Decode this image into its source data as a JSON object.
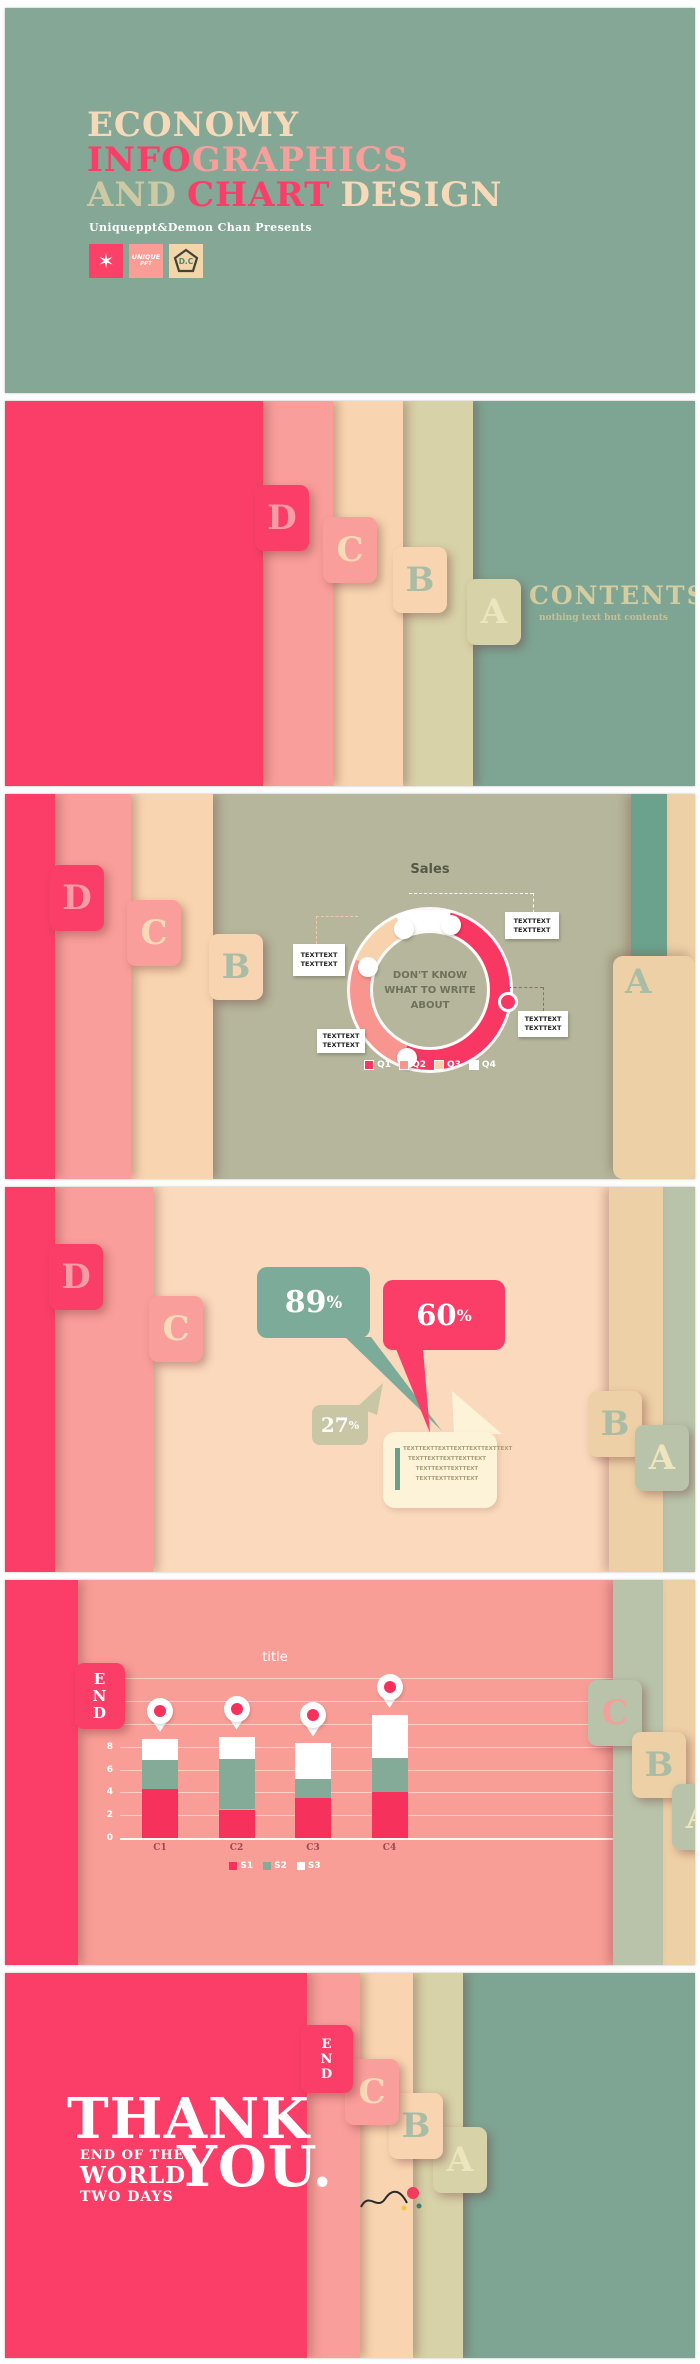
{
  "slide1": {
    "title": {
      "economy": "ECONOMY",
      "info": "INFO",
      "graphics": "GRAPHICS",
      "and": "AND",
      "chart": "CHART",
      "design": "DESIGN"
    },
    "presenter": "Uniqueppt&Demon Chan Presents",
    "badges": {
      "star_icon": "✶",
      "unique_line1": "UNIQUE",
      "unique_line2": "PPT",
      "dc_text": "D.C"
    }
  },
  "slide2": {
    "tabs": {
      "d": "D",
      "c": "C",
      "b": "B",
      "a": "A"
    },
    "contents_title": "CONTENTS",
    "contents_subtitle": "nothing text but contents"
  },
  "slide3": {
    "tabs": {
      "d": "D",
      "c": "C",
      "b": "B",
      "a": "A"
    },
    "callout_line1": "TEXTTEXT",
    "callout_line2": "TEXTTEXT"
  },
  "slide4": {
    "tabs": {
      "d": "D",
      "c": "C",
      "b": "B",
      "a": "A"
    },
    "bubble_green": {
      "value": "89",
      "unit": "%"
    },
    "bubble_red": {
      "value": "60",
      "unit": "%"
    },
    "bubble_olive": {
      "value": "27",
      "unit": "%"
    },
    "note_lines": [
      "TEXTTEXTTEXTTEXTTEXTTEXTTEXT",
      "TEXTTEXTTEXTTEXTTEXT",
      "TEXTTEXTTEXTTEXT",
      "TEXTTEXTTEXTTEXT"
    ]
  },
  "slide5": {
    "end_tab": [
      "E",
      "N",
      "D"
    ],
    "tabs": {
      "c": "C",
      "b": "B",
      "a": "A"
    }
  },
  "slide6": {
    "end_tab": [
      "E",
      "N",
      "D"
    ],
    "tabs": {
      "c": "C",
      "b": "B",
      "a": "A"
    },
    "thank": "THANK",
    "you": "YOU.",
    "sub_line1": "END OF THE",
    "sub_line2": "WORLD",
    "sub_line3": "TWO DAYS"
  },
  "chart_data": [
    {
      "type": "pie",
      "variant": "donut",
      "title": "Sales",
      "labels": [
        "Q1",
        "Q2",
        "Q3",
        "Q4"
      ],
      "values": [
        52,
        25,
        12,
        11
      ],
      "colors": [
        "#f93763",
        "#f8958e",
        "#f7d3ad",
        "#ffffff"
      ],
      "start_angle_deg": 15,
      "marker_angle_deg": 97,
      "center_text": [
        "DON'T KNOW",
        "WHAT TO WRITE ABOUT"
      ],
      "callouts": [
        "TEXTTEXT TEXTTEXT",
        "TEXTTEXT TEXTTEXT",
        "TEXTTEXT TEXTTEXT",
        "TEXTTEXT TEXTTEXT"
      ],
      "legend_position": "bottom"
    },
    {
      "type": "bar",
      "stacked": true,
      "title": "title",
      "categories": [
        "C1",
        "C2",
        "C3",
        "C4"
      ],
      "series": [
        {
          "name": "S1",
          "color": "#f6325c",
          "values": [
            4.3,
            2.5,
            3.5,
            4.0
          ]
        },
        {
          "name": "S2",
          "color": "#84ab97",
          "values": [
            2.5,
            4.4,
            1.7,
            3.0
          ]
        },
        {
          "name": "S3",
          "color": "#ffffff",
          "values": [
            1.9,
            2.0,
            3.1,
            3.8
          ]
        }
      ],
      "ylim": [
        0,
        14
      ],
      "yticks": [
        0,
        2,
        4,
        6,
        8
      ],
      "gridline_step": 2,
      "marker": "location-pin",
      "legend_position": "bottom"
    }
  ]
}
